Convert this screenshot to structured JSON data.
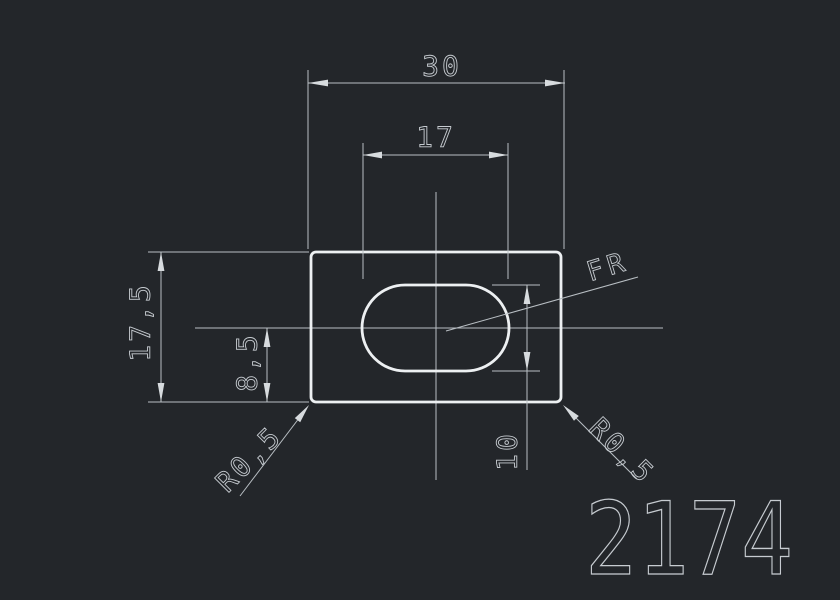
{
  "canvas": {
    "background_color": "#23262a",
    "geometry_color": "#edf0f2",
    "dimension_color": "#b9bfc4",
    "text_color": "#c6cbd0"
  },
  "drawing": {
    "part_number": "2174",
    "note": "FR",
    "dimensions": {
      "overall_width": "30",
      "slot_width": "17",
      "overall_height": "17,5",
      "centerline_to_bottom": "8,5",
      "slot_height": "10",
      "corner_fillet_left": "R0,5",
      "corner_fillet_right": "R0,5"
    }
  }
}
